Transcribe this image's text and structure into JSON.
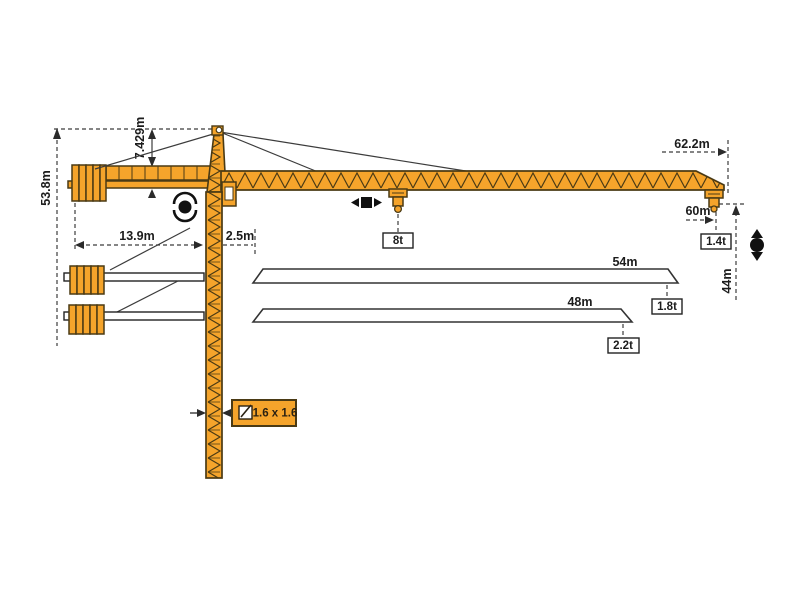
{
  "diagram": {
    "kind": "tower-crane-dimension-diagram",
    "colors": {
      "crane_orange": "#F5A42B",
      "crane_outline": "#4A3A14",
      "line_dark": "#3C3C3C",
      "background": "#FFFFFF"
    },
    "labels": {
      "total_height": "53.8m",
      "head_height": "7.429m",
      "counter_radius": "13.9m",
      "root_offset": "2.5m",
      "tip_length": "62.2m",
      "max_radius": "60m",
      "tip_capacity": "1.4t",
      "hook_height": "44m",
      "mid_capacity": "8t",
      "jib54_length": "54m",
      "jib54_capacity": "1.8t",
      "jib48_length": "48m",
      "jib48_capacity": "2.2t",
      "mast_section": "1.6 x 1.6"
    },
    "configurations": [
      {
        "jib_length": "62.2m",
        "hook_radius": "60m",
        "capacity": "1.4t"
      },
      {
        "jib_length": "54m",
        "capacity": "1.8t"
      },
      {
        "jib_length": "48m",
        "capacity": "2.2t"
      }
    ],
    "icons": [
      "slewing-icon",
      "trolley-travel-icon",
      "hoist-icon",
      "mast-cross-section-icon"
    ]
  }
}
